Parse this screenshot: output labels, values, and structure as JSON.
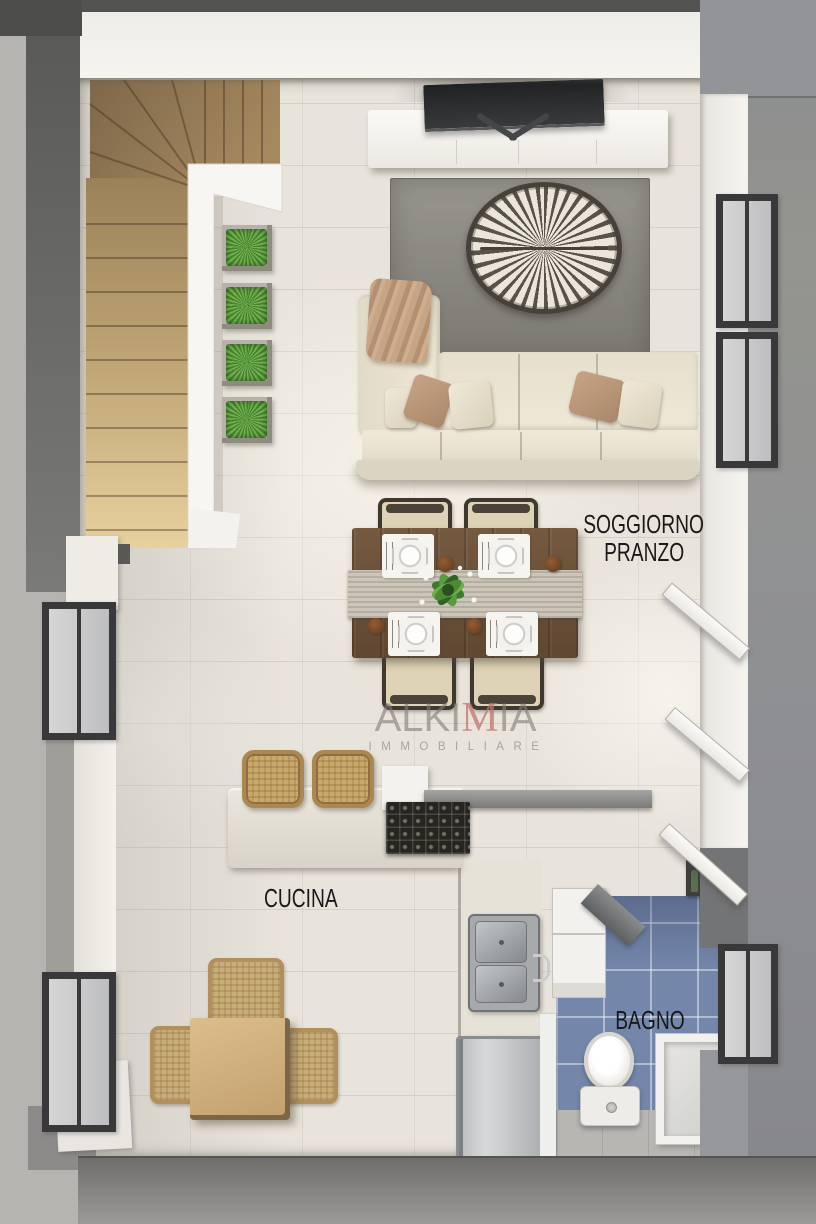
{
  "scene": {
    "type": "apartment-floor-plan-render",
    "view": "top-down 3d render",
    "rooms_shown": [
      "soggiorno-pranzo",
      "cucina",
      "bagno",
      "scala"
    ]
  },
  "labels": {
    "living_line1": "SOGGIORNO",
    "living_line2": "PRANZO",
    "kitchen": "CUCINA",
    "bathroom": "BAGNO"
  },
  "watermark": {
    "brand_prefix": "ALKI",
    "brand_accent": "M",
    "brand_suffix": "IA",
    "tagline": "IMMOBILIARE"
  },
  "palette": {
    "floor_tile": "#e9e4db",
    "wall_white": "#f3f1ec",
    "wall_gray": "#8e8f93",
    "wood_stairs": "#c9a876",
    "dining_wood": "#6f563e",
    "sofa_cream": "#eae3d2",
    "rug_gray": "#8b8983",
    "bath_tile_blue": "#7487ab",
    "plant_green": "#5a9440",
    "watermark_accent": "#c0736c",
    "label_text": "#191919"
  },
  "furniture": [
    "staircase",
    "planters",
    "tv",
    "media-console",
    "rug",
    "coffee-table",
    "sofa",
    "dining-table",
    "dining-chairs",
    "table-runner",
    "place-settings",
    "kitchen-counter",
    "bar-stools",
    "cooktop",
    "sink",
    "refrigerator",
    "breakfast-table",
    "wicker-chairs",
    "washer-cabinets",
    "vanity",
    "toilet",
    "shower-tray",
    "entry-door",
    "bathroom-door",
    "windows"
  ]
}
